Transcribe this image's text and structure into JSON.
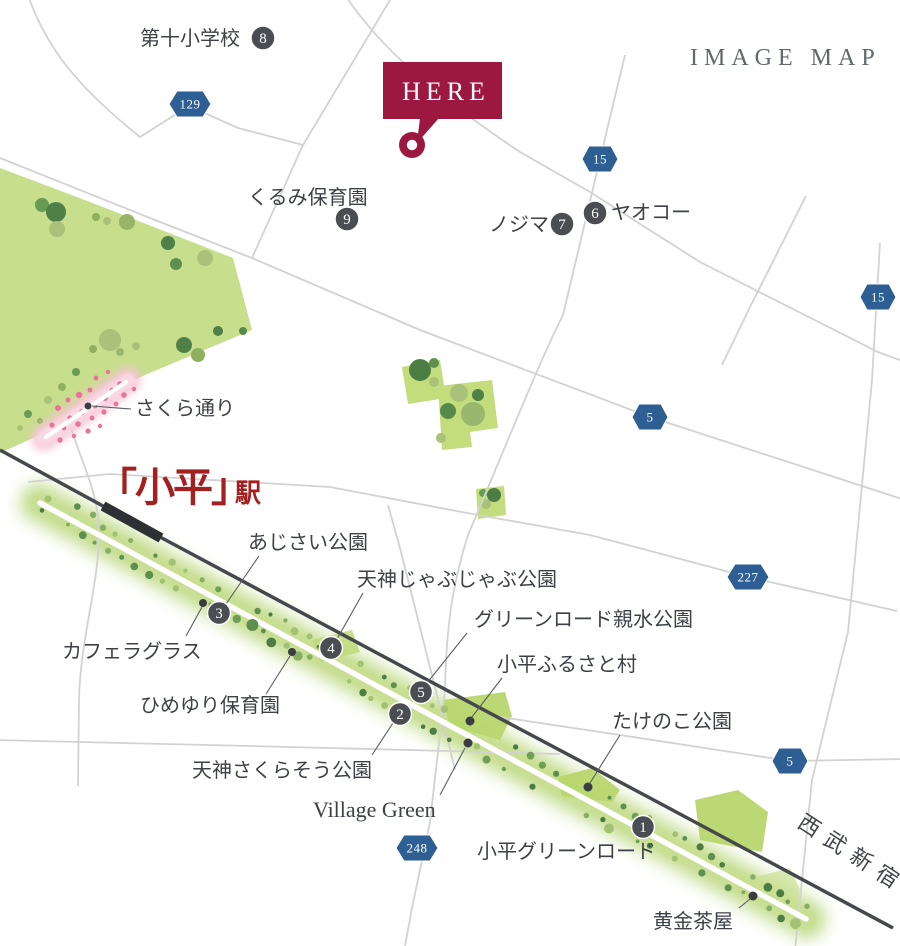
{
  "map_title": "IMAGE MAP",
  "here": {
    "label": "HERE"
  },
  "station": {
    "name": "「小平」",
    "suffix": "駅"
  },
  "rail_line": {
    "name": "西武新宿線"
  },
  "streets": {
    "sakura": "さくら通り",
    "green_road": "小平グリーンロード"
  },
  "shields": [
    {
      "number": "129"
    },
    {
      "number": "15"
    },
    {
      "number": "15"
    },
    {
      "number": "5"
    },
    {
      "number": "227"
    },
    {
      "number": "5"
    },
    {
      "number": "248"
    }
  ],
  "pois": [
    {
      "badge": "8",
      "label": "第十小学校"
    },
    {
      "badge": "9",
      "label": "くるみ保育園"
    },
    {
      "badge": "7",
      "label": "ノジマ"
    },
    {
      "badge": "6",
      "label": "ヤオコー"
    },
    {
      "badge": "3",
      "label": "あじさい公園"
    },
    {
      "badge": "4",
      "label": "天神じゃぶじゃぶ公園"
    },
    {
      "badge": "5",
      "label": "グリーンロード親水公園"
    },
    {
      "badge": "2",
      "label": "天神さくらそう公園"
    },
    {
      "badge": "1",
      "label": "たけのこ公園"
    },
    {
      "label": "カフェラグラス"
    },
    {
      "label": "ひめゆり保育園"
    },
    {
      "label": "小平ふるさと村"
    },
    {
      "label": "Village Green"
    },
    {
      "label": "黄金茶屋"
    }
  ],
  "colors": {
    "accent_maroon": "#9c1840",
    "station_red": "#a32020",
    "shield_blue": "#2d5e94",
    "badge_gray": "#4a4e53",
    "park_green": "#c7de8c",
    "band_green": "#c6dd8d",
    "sakura_pink": "#f5bcd0"
  }
}
